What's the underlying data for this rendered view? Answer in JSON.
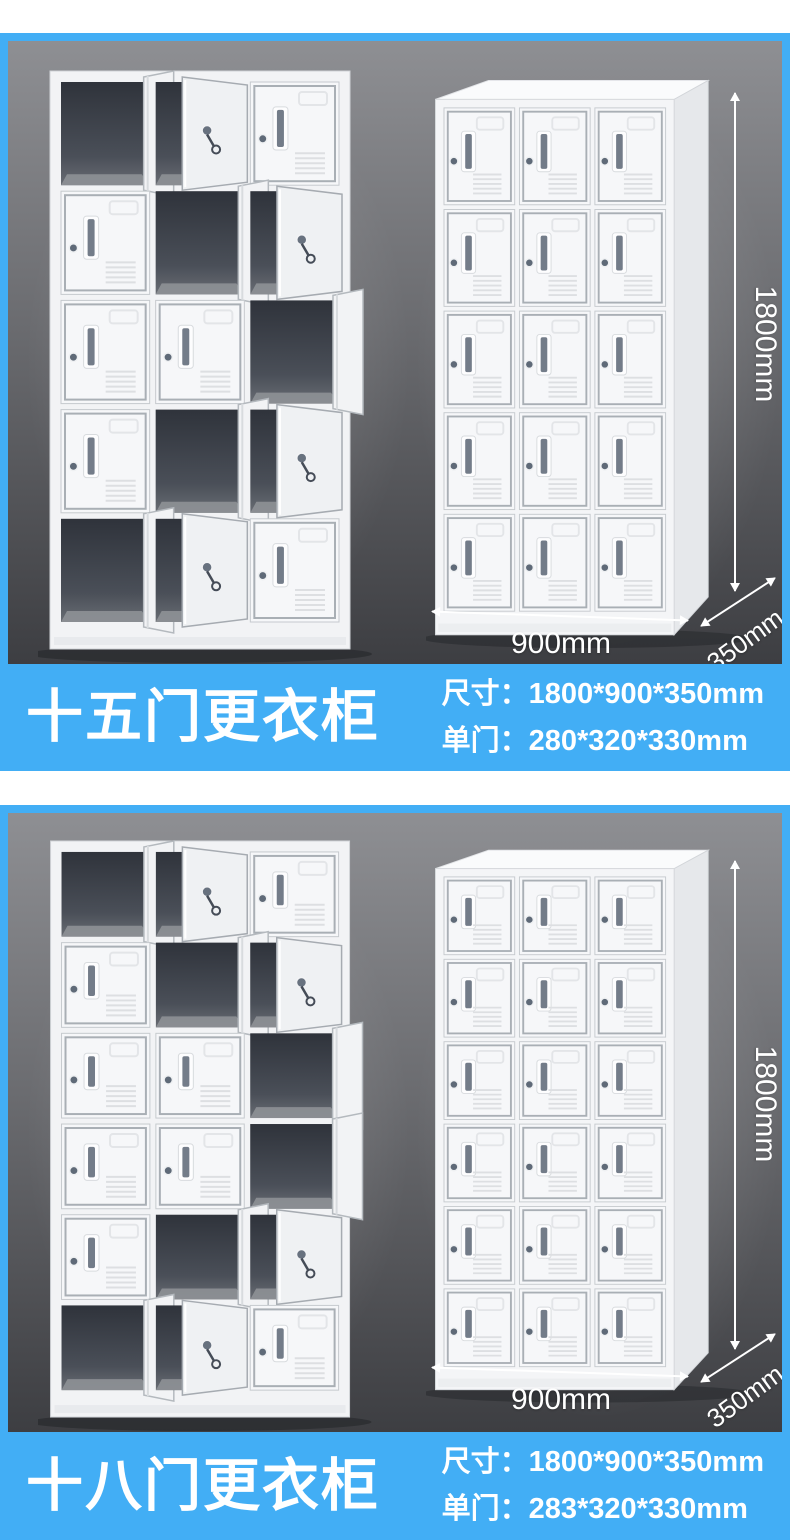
{
  "colors": {
    "accent_blue": "#42aef5",
    "photo_bg_top": "#8e8f93",
    "photo_bg_bottom": "#3d3e42",
    "banner_text": "#ffffff"
  },
  "sections": [
    {
      "title": "十五门更衣柜",
      "spec_size": "尺寸：1800*900*350mm",
      "spec_door": "单门：280*320*330mm",
      "dims": {
        "height": "1800mm",
        "width": "900mm",
        "depth": "350mm"
      },
      "open_locker": {
        "cols": 3,
        "rows": 5,
        "states": [
          [
            "open",
            "ajar",
            "closed"
          ],
          [
            "closed",
            "open",
            "ajar"
          ],
          [
            "closed",
            "closed",
            "open"
          ],
          [
            "closed",
            "open",
            "ajar"
          ],
          [
            "open",
            "ajar",
            "closed"
          ]
        ]
      },
      "closed_locker": {
        "cols": 3,
        "rows": 5
      }
    },
    {
      "title": "十八门更衣柜",
      "spec_size": "尺寸：1800*900*350mm",
      "spec_door": "单门：283*320*330mm",
      "dims": {
        "height": "1800mm",
        "width": "900mm",
        "depth": "350mm"
      },
      "open_locker": {
        "cols": 3,
        "rows": 6,
        "states": [
          [
            "open",
            "ajar",
            "closed"
          ],
          [
            "closed",
            "open",
            "ajar"
          ],
          [
            "closed",
            "closed",
            "open"
          ],
          [
            "closed",
            "closed",
            "open"
          ],
          [
            "closed",
            "open",
            "ajar"
          ],
          [
            "open",
            "ajar",
            "closed"
          ]
        ]
      },
      "closed_locker": {
        "cols": 3,
        "rows": 6
      }
    }
  ]
}
